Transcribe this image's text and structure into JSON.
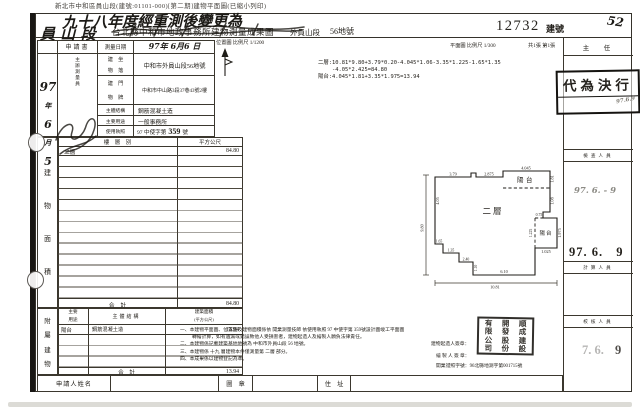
{
  "scan_header": "新北市中和區員山段(建號:01101-000)[第二期]建物平面圖(已縮小列印)",
  "title": {
    "amendment_line1": "九十八年度經重測後變更為",
    "amendment_line2": "員 山 段",
    "printed_title": "台北縣中和市地政事務所建物測量成果圖",
    "section_name": "外員山段",
    "lot_no": "56地號",
    "building_no": "12732",
    "building_no_suffix": "建號",
    "page_note": "52"
  },
  "scales": {
    "location": "位置圖 比例尺 1/1200",
    "plan": "平面圖 比例尺 1/300",
    "sheet": "共1張 第1張"
  },
  "calc": {
    "line1": "二層:10.81*9.80+3.79*0.20-4.045*1.06-3.35*1.225-1.65*1.35",
    "line2": "-4.05*2.425=84.80",
    "line3": "陽台:4.045*1.81+3.35*1.975=13.94"
  },
  "form": {
    "application": "申請書",
    "survey_date_label": "測量日期",
    "survey_date_value": "97年 6月6 日",
    "surveyor_label": "主辦測量員",
    "hw_date": [
      "97",
      "年",
      "6",
      "月",
      "5"
    ],
    "site_label_l1": "建　坐",
    "site_label_l2": "物　落",
    "site_value": "中和市外員山段56地號",
    "addr_label_l1": "建　門",
    "addr_label_l2": "物　牌",
    "addr_value": "中和市中山路3段37巷43號2樓",
    "structure_label": "主體結構",
    "structure_value": "鋼筋混凝土造",
    "use_label": "主要用途",
    "use_value": "一般事務所",
    "permit_label": "使用執照",
    "permit_prefix": "97 中使字第",
    "permit_no": "359",
    "permit_suffix": "號"
  },
  "area_table": {
    "section": [
      "建",
      "物",
      "面",
      "積"
    ],
    "floor_col": "樓　層　別",
    "sqm_col": "平方公尺",
    "floor_1": "二層",
    "area_1": "84.80",
    "total_label": "合　計",
    "total": "84.80"
  },
  "annex": {
    "section": [
      "附",
      "屬",
      "建",
      "物"
    ],
    "use_col_l1": "主要",
    "use_col_l2": "用途",
    "structure_col": "主體結構",
    "area_col_l1": "建築面積",
    "area_col_l2": "(平方公尺)",
    "use_1": "陽台",
    "structure_1": "鋼筋混凝土造",
    "area_1": "13.94",
    "total_label": "合　計",
    "total": "13.94"
  },
  "applicant": {
    "name_label": "申請人姓名",
    "seal_label": "圖　章",
    "address_label": "住　址"
  },
  "plan": {
    "floor_label": "二層",
    "balcony_top_label": "陽台",
    "balcony_right_label": "陽台",
    "dims": {
      "top1": "3.79",
      "top2": "2.875",
      "bal_top_w": "4.045",
      "bal_top_h": "1.81",
      "right1": "1.08",
      "right2": "0.75",
      "bal_right_h": "1.975",
      "bal_right_w": "1.025",
      "bal_right_inner": "1.225",
      "left_upper": "4.05",
      "step1": "1.65",
      "step2": "1.35",
      "step3": "2.40",
      "step4": "1.10",
      "bottom_inner": "6.10",
      "bottom_total": "10.81",
      "left_total": "9.80"
    }
  },
  "approval": {
    "chief_label": "主　任",
    "check_label": "檢查人員",
    "calc_label": "計算人員",
    "review_label": "校核人員",
    "delegate_stamp": "代為決行",
    "stamp_note": "97.6.9",
    "pencil_date": "97. 6. - 9",
    "date_stamp": "97. 6.",
    "date_stamp_day": "9",
    "faint_date": "7. 6.",
    "faint_date_day": "9"
  },
  "notes": {
    "n1a": "一、本建物平面圖、位置圖及建物面積係依 開業測量技師 依使用執照 97 中使字第 359號設計圖竣工平面圖",
    "n1b": "轉繪計算，如有遺漏或錯誤致他人受損害者，建物起造人及繪製人願負法律責任。",
    "n2": "二、本建物係記載建築基地地號為 中和市外員山段 56 地號。",
    "n3": "三、本建物係 十九 層建物本件僅測量第 二層 部分。",
    "n4": "四、本成果係以建物登記為準。",
    "builder_sign": "建物起造人簽章：",
    "drafter_sign": "繪 製 人 簽 章：",
    "license": "開業證照字號：96北縣地測字第001715號"
  },
  "seal": {
    "col1": "順成建設",
    "col2": "開發股份",
    "col3": "有限公司"
  }
}
